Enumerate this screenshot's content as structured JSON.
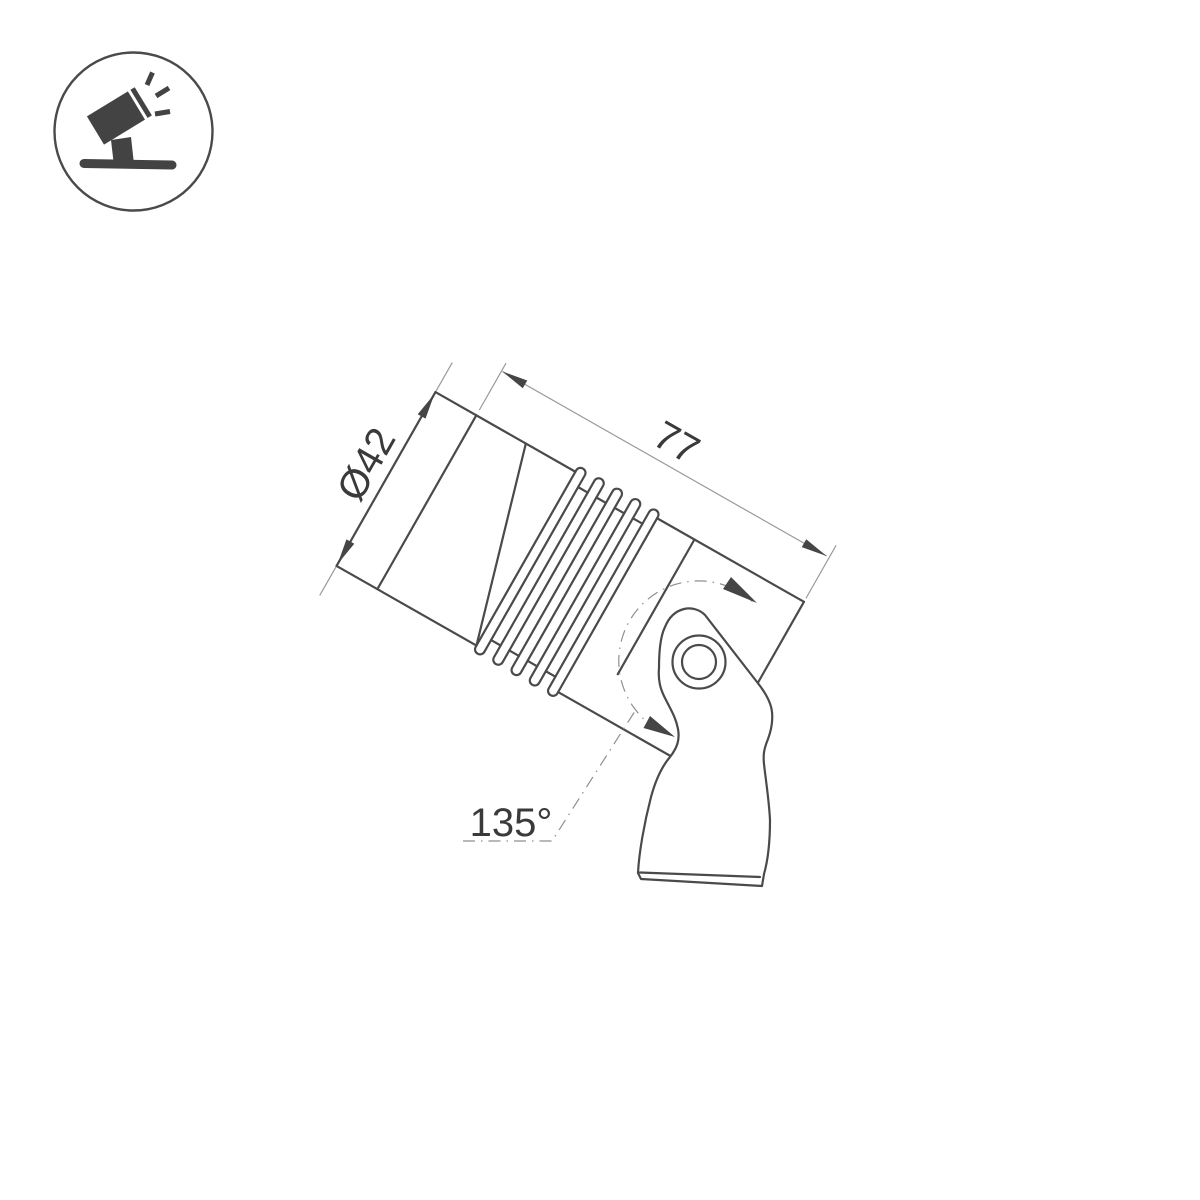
{
  "page": {
    "background": "#ffffff"
  },
  "icon": {
    "name": "tilted-spotlight-with-rays-on-ground-icon"
  },
  "drawing": {
    "type": "technical-dimension-diagram",
    "subject": "adjustable spotlight fixture, side view with swivel bracket",
    "dimensions": {
      "diameter": {
        "label": "Ø42"
      },
      "length": {
        "label": "77"
      },
      "rotation_angle": {
        "label": "135°"
      }
    },
    "colors": {
      "outline": "#4a4a4a",
      "dimension_lines": "#9a9a9a",
      "text": "#3a3a3a",
      "background": "#ffffff"
    }
  }
}
